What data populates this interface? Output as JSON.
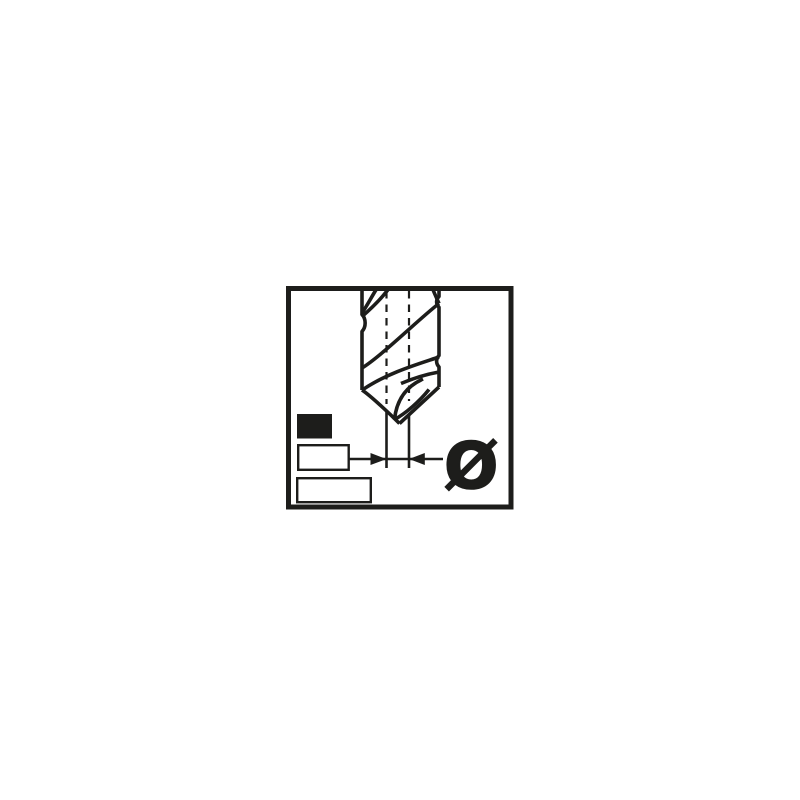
{
  "pictogram": {
    "diameter_symbol": "Ø",
    "colors": {
      "ink": "#1d1d1b",
      "background": "#ffffff"
    },
    "icons": [
      "twist-drill-icon",
      "centerline-dashed-icon",
      "diameter-dimension-arrows-icon",
      "filled-rectangle-swatch-icon",
      "outline-rectangle-swatch-icon",
      "outline-rectangle-swatch-icon"
    ]
  }
}
